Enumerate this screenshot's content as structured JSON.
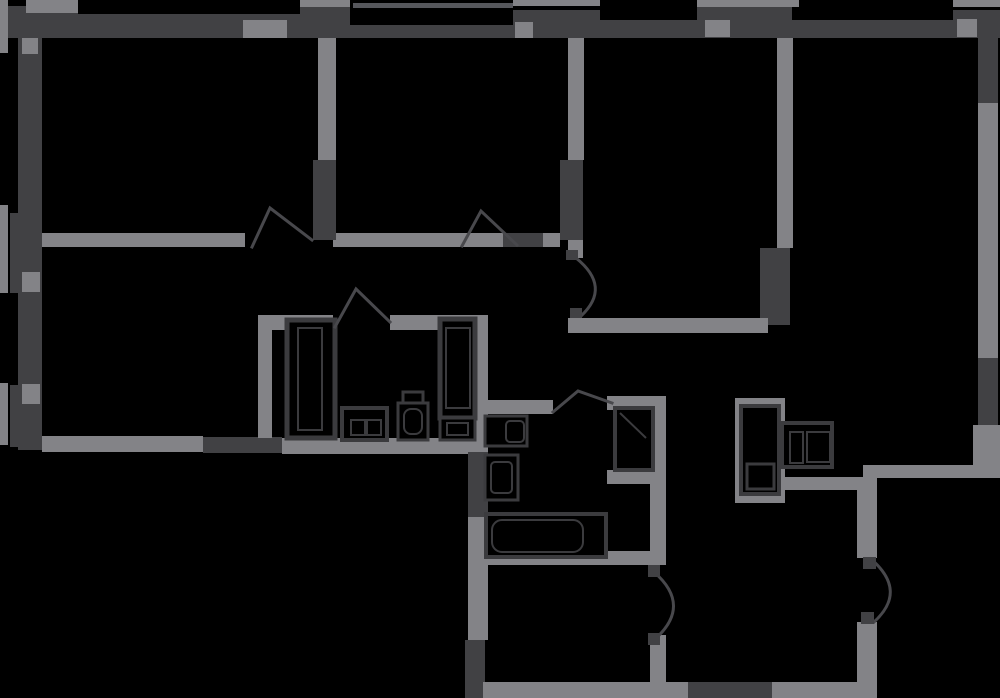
{
  "canvas": {
    "width": 1000,
    "height": 698,
    "background": "#000000"
  },
  "palette": {
    "dark": "#414144",
    "light": "#838387",
    "mid": "#56575c",
    "fixture_stroke": "#3b3b3e",
    "arc_stroke": "#48484c"
  },
  "walls": [
    {
      "n": "top-wall-left-block",
      "x": 8,
      "y": 6,
      "w": 70,
      "h": 32,
      "c": "dark"
    },
    {
      "n": "top-wall-left-edge",
      "x": 0,
      "y": 12,
      "w": 8,
      "h": 26,
      "c": "dark"
    },
    {
      "n": "top-wall-seg-1",
      "x": 78,
      "y": 14,
      "w": 272,
      "h": 24,
      "c": "dark"
    },
    {
      "n": "top-wall-block-2",
      "x": 300,
      "y": 6,
      "w": 50,
      "h": 12,
      "c": "dark"
    },
    {
      "n": "top-wall-seg-2",
      "x": 350,
      "y": 25,
      "w": 163,
      "h": 13,
      "c": "dark"
    },
    {
      "n": "balcony-rail",
      "x": 353,
      "y": 3,
      "w": 160,
      "h": 5,
      "c": "mid"
    },
    {
      "n": "top-wall-block-3",
      "x": 513,
      "y": 10,
      "w": 87,
      "h": 28,
      "c": "dark"
    },
    {
      "n": "top-wall-seg-3",
      "x": 600,
      "y": 20,
      "w": 97,
      "h": 18,
      "c": "dark"
    },
    {
      "n": "top-wall-block-4",
      "x": 697,
      "y": 7,
      "w": 95,
      "h": 31,
      "c": "dark"
    },
    {
      "n": "top-wall-seg-4",
      "x": 792,
      "y": 20,
      "w": 161,
      "h": 18,
      "c": "dark"
    },
    {
      "n": "top-wall-block-5",
      "x": 953,
      "y": 10,
      "w": 47,
      "h": 28,
      "c": "dark"
    },
    {
      "n": "top-cap-1",
      "x": 26,
      "y": 0,
      "w": 52,
      "h": 13,
      "c": "light"
    },
    {
      "n": "top-cap-2",
      "x": 300,
      "y": 0,
      "w": 50,
      "h": 7,
      "c": "light"
    },
    {
      "n": "top-cap-3",
      "x": 513,
      "y": 0,
      "w": 87,
      "h": 6,
      "c": "light"
    },
    {
      "n": "top-cap-4",
      "x": 697,
      "y": 0,
      "w": 102,
      "h": 7,
      "c": "light"
    },
    {
      "n": "top-cap-5",
      "x": 953,
      "y": 0,
      "w": 47,
      "h": 7,
      "c": "light"
    },
    {
      "n": "top-window-1",
      "x": 243,
      "y": 20,
      "w": 44,
      "h": 18,
      "c": "light"
    },
    {
      "n": "top-window-2",
      "x": 515,
      "y": 22,
      "w": 18,
      "h": 16,
      "c": "light"
    },
    {
      "n": "top-window-3",
      "x": 705,
      "y": 20,
      "w": 25,
      "h": 17,
      "c": "light"
    },
    {
      "n": "top-window-4",
      "x": 957,
      "y": 19,
      "w": 20,
      "h": 18,
      "c": "light"
    },
    {
      "n": "left-wall",
      "x": 18,
      "y": 38,
      "w": 24,
      "h": 412,
      "c": "dark"
    },
    {
      "n": "left-wall-block-1",
      "x": 10,
      "y": 213,
      "w": 32,
      "h": 80,
      "c": "dark"
    },
    {
      "n": "left-wall-block-2",
      "x": 10,
      "y": 385,
      "w": 32,
      "h": 62,
      "c": "dark"
    },
    {
      "n": "left-edge-strip-1",
      "x": 0,
      "y": 0,
      "w": 8,
      "h": 53,
      "c": "light"
    },
    {
      "n": "left-edge-strip-2",
      "x": 0,
      "y": 205,
      "w": 8,
      "h": 88,
      "c": "light"
    },
    {
      "n": "left-edge-strip-3",
      "x": 0,
      "y": 383,
      "w": 8,
      "h": 62,
      "c": "light"
    },
    {
      "n": "left-window-1",
      "x": 22,
      "y": 38,
      "w": 16,
      "h": 16,
      "c": "light"
    },
    {
      "n": "left-window-2",
      "x": 22,
      "y": 272,
      "w": 18,
      "h": 20,
      "c": "light"
    },
    {
      "n": "left-window-3",
      "x": 22,
      "y": 384,
      "w": 18,
      "h": 20,
      "c": "light"
    },
    {
      "n": "right-wall-top",
      "x": 978,
      "y": 38,
      "w": 20,
      "h": 65,
      "c": "dark"
    },
    {
      "n": "right-wall-window",
      "x": 978,
      "y": 103,
      "w": 20,
      "h": 255,
      "c": "light"
    },
    {
      "n": "right-wall-mid",
      "x": 978,
      "y": 358,
      "w": 20,
      "h": 67,
      "c": "dark"
    },
    {
      "n": "right-wall-low",
      "x": 973,
      "y": 425,
      "w": 27,
      "h": 53,
      "c": "light"
    },
    {
      "n": "corridor-wall-a",
      "x": 42,
      "y": 233,
      "w": 203,
      "h": 14,
      "c": "light"
    },
    {
      "n": "corridor-wall-b",
      "x": 333,
      "y": 233,
      "w": 170,
      "h": 14,
      "c": "light"
    },
    {
      "n": "corridor-wall-c",
      "x": 503,
      "y": 233,
      "w": 40,
      "h": 14,
      "c": "dark"
    },
    {
      "n": "corridor-wall-d",
      "x": 543,
      "y": 233,
      "w": 17,
      "h": 14,
      "c": "light"
    },
    {
      "n": "bedroom1-wall",
      "x": 318,
      "y": 38,
      "w": 18,
      "h": 122,
      "c": "light"
    },
    {
      "n": "bedroom1-wall-dark",
      "x": 313,
      "y": 160,
      "w": 23,
      "h": 80,
      "c": "dark"
    },
    {
      "n": "bedroom2-wall",
      "x": 568,
      "y": 38,
      "w": 16,
      "h": 122,
      "c": "light"
    },
    {
      "n": "bedroom2-wall-dark",
      "x": 560,
      "y": 160,
      "w": 23,
      "h": 80,
      "c": "dark"
    },
    {
      "n": "bedroom2-wall-low",
      "x": 568,
      "y": 240,
      "w": 15,
      "h": 18,
      "c": "light"
    },
    {
      "n": "living-wall",
      "x": 777,
      "y": 38,
      "w": 16,
      "h": 210,
      "c": "light"
    },
    {
      "n": "living-wall-dark",
      "x": 760,
      "y": 248,
      "w": 30,
      "h": 77,
      "c": "dark"
    },
    {
      "n": "hall-top-wall",
      "x": 568,
      "y": 318,
      "w": 200,
      "h": 15,
      "c": "light"
    },
    {
      "n": "room-bottom-wall-a",
      "x": 42,
      "y": 436,
      "w": 161,
      "h": 16,
      "c": "light"
    },
    {
      "n": "room-bottom-wall-b",
      "x": 203,
      "y": 437,
      "w": 79,
      "h": 16,
      "c": "dark"
    },
    {
      "n": "room-bottom-wall-c",
      "x": 282,
      "y": 438,
      "w": 206,
      "h": 16,
      "c": "light"
    },
    {
      "n": "closet-wall-left",
      "x": 258,
      "y": 330,
      "w": 14,
      "h": 108,
      "c": "light"
    },
    {
      "n": "closet-wall-top-a",
      "x": 258,
      "y": 315,
      "w": 75,
      "h": 15,
      "c": "light"
    },
    {
      "n": "closet-wall-top-b",
      "x": 390,
      "y": 315,
      "w": 98,
      "h": 15,
      "c": "light"
    },
    {
      "n": "wet-wall-light-1",
      "x": 468,
      "y": 315,
      "w": 20,
      "h": 137,
      "c": "light"
    },
    {
      "n": "wet-wall-dark-1",
      "x": 468,
      "y": 452,
      "w": 20,
      "h": 65,
      "c": "dark"
    },
    {
      "n": "wet-wall-light-2",
      "x": 468,
      "y": 517,
      "w": 20,
      "h": 123,
      "c": "light"
    },
    {
      "n": "wet-wall-dark-2",
      "x": 465,
      "y": 640,
      "w": 20,
      "h": 58,
      "c": "dark"
    },
    {
      "n": "bath-top-wall",
      "x": 488,
      "y": 400,
      "w": 65,
      "h": 14,
      "c": "light"
    },
    {
      "n": "shaft1-top-wall",
      "x": 607,
      "y": 396,
      "w": 56,
      "h": 14,
      "c": "light"
    },
    {
      "n": "shaft1-bottom-wall",
      "x": 607,
      "y": 470,
      "w": 43,
      "h": 14,
      "c": "light"
    },
    {
      "n": "bath-right-wall",
      "x": 650,
      "y": 396,
      "w": 16,
      "h": 166,
      "c": "light"
    },
    {
      "n": "bath-right-wall-low",
      "x": 650,
      "y": 635,
      "w": 16,
      "h": 47,
      "c": "light"
    },
    {
      "n": "bath-bottom-wall",
      "x": 470,
      "y": 551,
      "w": 196,
      "h": 14,
      "c": "light"
    },
    {
      "n": "shaft2-frame",
      "x": 735,
      "y": 398,
      "w": 50,
      "h": 105,
      "c": "light"
    },
    {
      "n": "kitchen-top-wall",
      "x": 785,
      "y": 477,
      "w": 78,
      "h": 13,
      "c": "light"
    },
    {
      "n": "lower-ext-wall",
      "x": 863,
      "y": 465,
      "w": 137,
      "h": 13,
      "c": "light"
    },
    {
      "n": "entry-wall-top",
      "x": 857,
      "y": 477,
      "w": 20,
      "h": 81,
      "c": "light"
    },
    {
      "n": "entry-wall-bottom",
      "x": 857,
      "y": 622,
      "w": 20,
      "h": 60,
      "c": "light"
    },
    {
      "n": "bottom-wall-a",
      "x": 483,
      "y": 682,
      "w": 205,
      "h": 16,
      "c": "light"
    },
    {
      "n": "bottom-wall-dark",
      "x": 688,
      "y": 682,
      "w": 84,
      "h": 16,
      "c": "dark"
    },
    {
      "n": "bottom-wall-b",
      "x": 772,
      "y": 682,
      "w": 105,
      "h": 16,
      "c": "light"
    }
  ],
  "fixtures": [
    {
      "n": "wardrobe-1",
      "x": 287,
      "y": 320,
      "w": 48,
      "h": 118,
      "sw": 5,
      "rx": 0
    },
    {
      "n": "wardrobe-1-inner",
      "x": 298,
      "y": 328,
      "w": 24,
      "h": 102,
      "sw": 2,
      "rx": 0
    },
    {
      "n": "wardrobe-2",
      "x": 440,
      "y": 319,
      "w": 35,
      "h": 99,
      "sw": 5,
      "rx": 0
    },
    {
      "n": "wardrobe-2-inner",
      "x": 446,
      "y": 328,
      "w": 24,
      "h": 80,
      "sw": 2,
      "rx": 0
    },
    {
      "n": "cabinet-small",
      "x": 440,
      "y": 418,
      "w": 35,
      "h": 22,
      "sw": 3,
      "rx": 0
    },
    {
      "n": "cabinet-small-inner",
      "x": 447,
      "y": 423,
      "w": 21,
      "h": 12,
      "sw": 2,
      "rx": 0
    },
    {
      "n": "stove-unit",
      "x": 342,
      "y": 408,
      "w": 45,
      "h": 32,
      "sw": 4,
      "rx": 0
    },
    {
      "n": "stove-burner-1",
      "x": 351,
      "y": 420,
      "w": 14,
      "h": 15,
      "sw": 2,
      "rx": 0
    },
    {
      "n": "stove-burner-2",
      "x": 367,
      "y": 420,
      "w": 14,
      "h": 15,
      "sw": 2,
      "rx": 0
    },
    {
      "n": "toilet-2-tank",
      "x": 403,
      "y": 392,
      "w": 20,
      "h": 14,
      "sw": 3,
      "rx": 0
    },
    {
      "n": "toilet-2-bowl",
      "x": 398,
      "y": 403,
      "w": 30,
      "h": 37,
      "sw": 3,
      "rx": 0
    },
    {
      "n": "toilet-2-seat",
      "x": 404,
      "y": 409,
      "w": 18,
      "h": 25,
      "sw": 2,
      "rx": 7
    },
    {
      "n": "toilet-1",
      "x": 485,
      "y": 416,
      "w": 42,
      "h": 30,
      "sw": 3,
      "rx": 0
    },
    {
      "n": "toilet-1-inner",
      "x": 506,
      "y": 421,
      "w": 18,
      "h": 21,
      "sw": 2,
      "rx": 4
    },
    {
      "n": "sink-1",
      "x": 485,
      "y": 455,
      "w": 33,
      "h": 45,
      "sw": 3,
      "rx": 0
    },
    {
      "n": "sink-1-inner",
      "x": 491,
      "y": 462,
      "w": 21,
      "h": 31,
      "sw": 2,
      "rx": 4
    },
    {
      "n": "bathtub",
      "x": 486,
      "y": 514,
      "w": 120,
      "h": 43,
      "sw": 4,
      "rx": 0
    },
    {
      "n": "bathtub-inner",
      "x": 492,
      "y": 520,
      "w": 91,
      "h": 32,
      "sw": 2,
      "rx": 10
    },
    {
      "n": "kitchen-cabinet",
      "x": 782,
      "y": 423,
      "w": 50,
      "h": 44,
      "sw": 4,
      "rx": 0
    },
    {
      "n": "kitchen-cabinet-inner-1",
      "x": 790,
      "y": 432,
      "w": 13,
      "h": 31,
      "sw": 2,
      "rx": 0
    },
    {
      "n": "kitchen-cabinet-inner-2",
      "x": 807,
      "y": 432,
      "w": 23,
      "h": 30,
      "sw": 2,
      "rx": 0
    },
    {
      "n": "vent-shaft-1",
      "x": 615,
      "y": 408,
      "w": 38,
      "h": 62,
      "sw": 4,
      "rx": 0
    },
    {
      "n": "vent-shaft-2",
      "x": 741,
      "y": 406,
      "w": 38,
      "h": 88,
      "sw": 4,
      "rx": 0
    },
    {
      "n": "vent-shaft-2-inner",
      "x": 747,
      "y": 464,
      "w": 27,
      "h": 25,
      "sw": 3,
      "rx": 0
    }
  ],
  "door_peaks": [
    {
      "n": "door-arc-bedroom-1",
      "pts": "252,247 270,208 312,240"
    },
    {
      "n": "door-arc-bedroom-2",
      "pts": "462,246 481,211 517,245"
    },
    {
      "n": "door-arc-closet",
      "pts": "335,327 356,289 390,322"
    },
    {
      "n": "door-arc-bathroom",
      "pts": "553,412 578,391 612,403"
    }
  ],
  "door_curves": [
    {
      "n": "door-arc-living",
      "d": "M576,258 Q612,287 581,316"
    },
    {
      "n": "door-arc-wc",
      "d": "M654,572 Q693,606 654,640"
    },
    {
      "n": "door-arc-entrance",
      "d": "M871,559 Q908,591 874,622"
    }
  ],
  "door_nubs": [
    {
      "n": "door-nub-living-top",
      "x": 566,
      "y": 250,
      "w": 12,
      "h": 10
    },
    {
      "n": "door-nub-living-bottom",
      "x": 570,
      "y": 308,
      "w": 12,
      "h": 10
    },
    {
      "n": "door-nub-wc-top",
      "x": 648,
      "y": 565,
      "w": 12,
      "h": 12
    },
    {
      "n": "door-nub-wc-bottom",
      "x": 648,
      "y": 633,
      "w": 12,
      "h": 12
    },
    {
      "n": "door-nub-entrance-top",
      "x": 863,
      "y": 557,
      "w": 13,
      "h": 12
    },
    {
      "n": "door-nub-entrance-bottom",
      "x": 861,
      "y": 612,
      "w": 13,
      "h": 12
    }
  ],
  "detail_lines": [
    {
      "n": "vent-shaft-1-diagonal",
      "x1": 620,
      "y1": 413,
      "x2": 646,
      "y2": 438
    }
  ]
}
